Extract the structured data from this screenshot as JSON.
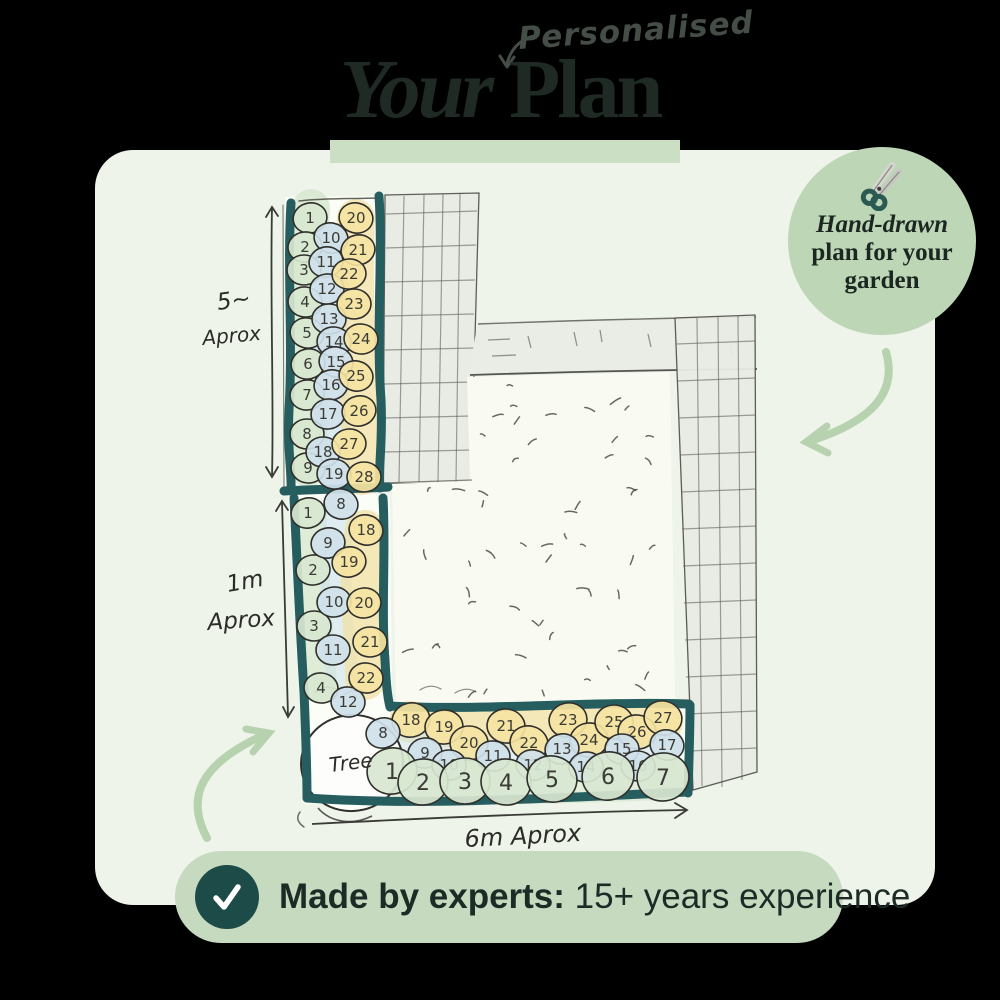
{
  "header": {
    "annotation": "Personalised",
    "title_italic": "Your",
    "title_bold": " Plan"
  },
  "badge": {
    "line1": "Hand-drawn",
    "line2": "plan for your",
    "line3": "garden"
  },
  "banner": {
    "bold_text": "Made by experts:",
    "regular_text": " 15+ years experience"
  },
  "plan": {
    "labels": {
      "left_upper_value": "5~",
      "left_upper_unit": "Aprox",
      "left_lower_value": "1m",
      "left_lower_unit": "Aprox",
      "bottom_dimension": "6m Aprox",
      "tree": "Tree"
    },
    "plant_colors": {
      "green": "#d8e7d0",
      "blue": "#cfe1ea",
      "yellow": "#f4e3a1"
    },
    "beds": [
      {
        "id": "left-upper",
        "plants": [
          {
            "n": "1",
            "c": "green",
            "x": 310,
            "y": 218
          },
          {
            "n": "2",
            "c": "green",
            "x": 305,
            "y": 247
          },
          {
            "n": "3",
            "c": "green",
            "x": 304,
            "y": 270
          },
          {
            "n": "4",
            "c": "green",
            "x": 305,
            "y": 302
          },
          {
            "n": "5",
            "c": "green",
            "x": 307,
            "y": 333
          },
          {
            "n": "6",
            "c": "green",
            "x": 308,
            "y": 364
          },
          {
            "n": "7",
            "c": "green",
            "x": 307,
            "y": 395
          },
          {
            "n": "8",
            "c": "green",
            "x": 307,
            "y": 434
          },
          {
            "n": "9",
            "c": "green",
            "x": 308,
            "y": 468
          },
          {
            "n": "10",
            "c": "blue",
            "x": 331,
            "y": 238
          },
          {
            "n": "11",
            "c": "blue",
            "x": 326,
            "y": 262
          },
          {
            "n": "12",
            "c": "blue",
            "x": 327,
            "y": 289
          },
          {
            "n": "13",
            "c": "blue",
            "x": 329,
            "y": 319
          },
          {
            "n": "14",
            "c": "blue",
            "x": 334,
            "y": 342
          },
          {
            "n": "15",
            "c": "blue",
            "x": 336,
            "y": 362
          },
          {
            "n": "16",
            "c": "blue",
            "x": 331,
            "y": 385
          },
          {
            "n": "17",
            "c": "blue",
            "x": 328,
            "y": 414
          },
          {
            "n": "18",
            "c": "blue",
            "x": 323,
            "y": 452
          },
          {
            "n": "19",
            "c": "blue",
            "x": 334,
            "y": 474
          },
          {
            "n": "20",
            "c": "yellow",
            "x": 356,
            "y": 218
          },
          {
            "n": "21",
            "c": "yellow",
            "x": 358,
            "y": 250
          },
          {
            "n": "22",
            "c": "yellow",
            "x": 349,
            "y": 274
          },
          {
            "n": "23",
            "c": "yellow",
            "x": 354,
            "y": 304
          },
          {
            "n": "24",
            "c": "yellow",
            "x": 361,
            "y": 339
          },
          {
            "n": "25",
            "c": "yellow",
            "x": 356,
            "y": 376
          },
          {
            "n": "26",
            "c": "yellow",
            "x": 359,
            "y": 411
          },
          {
            "n": "27",
            "c": "yellow",
            "x": 349,
            "y": 444
          },
          {
            "n": "28",
            "c": "yellow",
            "x": 364,
            "y": 477
          }
        ]
      },
      {
        "id": "left-lower",
        "plants": [
          {
            "n": "1",
            "c": "green",
            "x": 308,
            "y": 513
          },
          {
            "n": "2",
            "c": "green",
            "x": 313,
            "y": 570
          },
          {
            "n": "3",
            "c": "green",
            "x": 314,
            "y": 626
          },
          {
            "n": "4",
            "c": "green",
            "x": 321,
            "y": 688
          },
          {
            "n": "8",
            "c": "blue",
            "x": 341,
            "y": 504
          },
          {
            "n": "9",
            "c": "blue",
            "x": 328,
            "y": 543
          },
          {
            "n": "10",
            "c": "blue",
            "x": 334,
            "y": 602
          },
          {
            "n": "11",
            "c": "blue",
            "x": 333,
            "y": 650
          },
          {
            "n": "12",
            "c": "blue",
            "x": 348,
            "y": 702
          },
          {
            "n": "18",
            "c": "yellow",
            "x": 366,
            "y": 530
          },
          {
            "n": "19",
            "c": "yellow",
            "x": 349,
            "y": 562
          },
          {
            "n": "20",
            "c": "yellow",
            "x": 364,
            "y": 603
          },
          {
            "n": "21",
            "c": "yellow",
            "x": 370,
            "y": 642
          },
          {
            "n": "22",
            "c": "yellow",
            "x": 366,
            "y": 678
          }
        ]
      },
      {
        "id": "bottom",
        "plants": [
          {
            "n": "18",
            "c": "yellow",
            "x": 411,
            "y": 720,
            "r": 18
          },
          {
            "n": "19",
            "c": "yellow",
            "x": 444,
            "y": 727,
            "r": 18
          },
          {
            "n": "20",
            "c": "yellow",
            "x": 469,
            "y": 743,
            "r": 18
          },
          {
            "n": "21",
            "c": "yellow",
            "x": 506,
            "y": 726,
            "r": 18
          },
          {
            "n": "22",
            "c": "yellow",
            "x": 529,
            "y": 743,
            "r": 18
          },
          {
            "n": "23",
            "c": "yellow",
            "x": 568,
            "y": 720,
            "r": 18
          },
          {
            "n": "24",
            "c": "yellow",
            "x": 589,
            "y": 740,
            "r": 18
          },
          {
            "n": "25",
            "c": "yellow",
            "x": 614,
            "y": 722,
            "r": 18
          },
          {
            "n": "26",
            "c": "yellow",
            "x": 637,
            "y": 732,
            "r": 18
          },
          {
            "n": "27",
            "c": "yellow",
            "x": 663,
            "y": 718,
            "r": 18
          },
          {
            "n": "8",
            "c": "blue",
            "x": 383,
            "y": 733
          },
          {
            "n": "9",
            "c": "blue",
            "x": 425,
            "y": 753
          },
          {
            "n": "10",
            "c": "blue",
            "x": 449,
            "y": 765
          },
          {
            "n": "11",
            "c": "blue",
            "x": 493,
            "y": 756
          },
          {
            "n": "12",
            "c": "blue",
            "x": 533,
            "y": 765
          },
          {
            "n": "13",
            "c": "blue",
            "x": 562,
            "y": 749
          },
          {
            "n": "14",
            "c": "blue",
            "x": 586,
            "y": 767
          },
          {
            "n": "15",
            "c": "blue",
            "x": 622,
            "y": 749
          },
          {
            "n": "16",
            "c": "blue",
            "x": 638,
            "y": 766
          },
          {
            "n": "17",
            "c": "blue",
            "x": 667,
            "y": 745
          },
          {
            "n": "1",
            "c": "green",
            "x": 392,
            "y": 771,
            "r": 24
          },
          {
            "n": "2",
            "c": "green",
            "x": 423,
            "y": 782,
            "r": 24
          },
          {
            "n": "3",
            "c": "green",
            "x": 465,
            "y": 781,
            "r": 24
          },
          {
            "n": "4",
            "c": "green",
            "x": 506,
            "y": 782,
            "r": 24
          },
          {
            "n": "5",
            "c": "green",
            "x": 552,
            "y": 779,
            "r": 24
          },
          {
            "n": "6",
            "c": "green",
            "x": 608,
            "y": 776,
            "r": 25
          },
          {
            "n": "7",
            "c": "green",
            "x": 663,
            "y": 777,
            "r": 25
          }
        ]
      }
    ]
  },
  "colors": {
    "card_bg": "#eef4ea",
    "title_text": "#1f2a24",
    "accent_bar_green": "#cbdfc5",
    "badge_green": "#bdd6b6",
    "banner_green": "#c5dabf",
    "check_circle_teal": "#1d4b48",
    "bed_border_teal": "#265e60",
    "arrow_green": "#b7d2ae"
  }
}
